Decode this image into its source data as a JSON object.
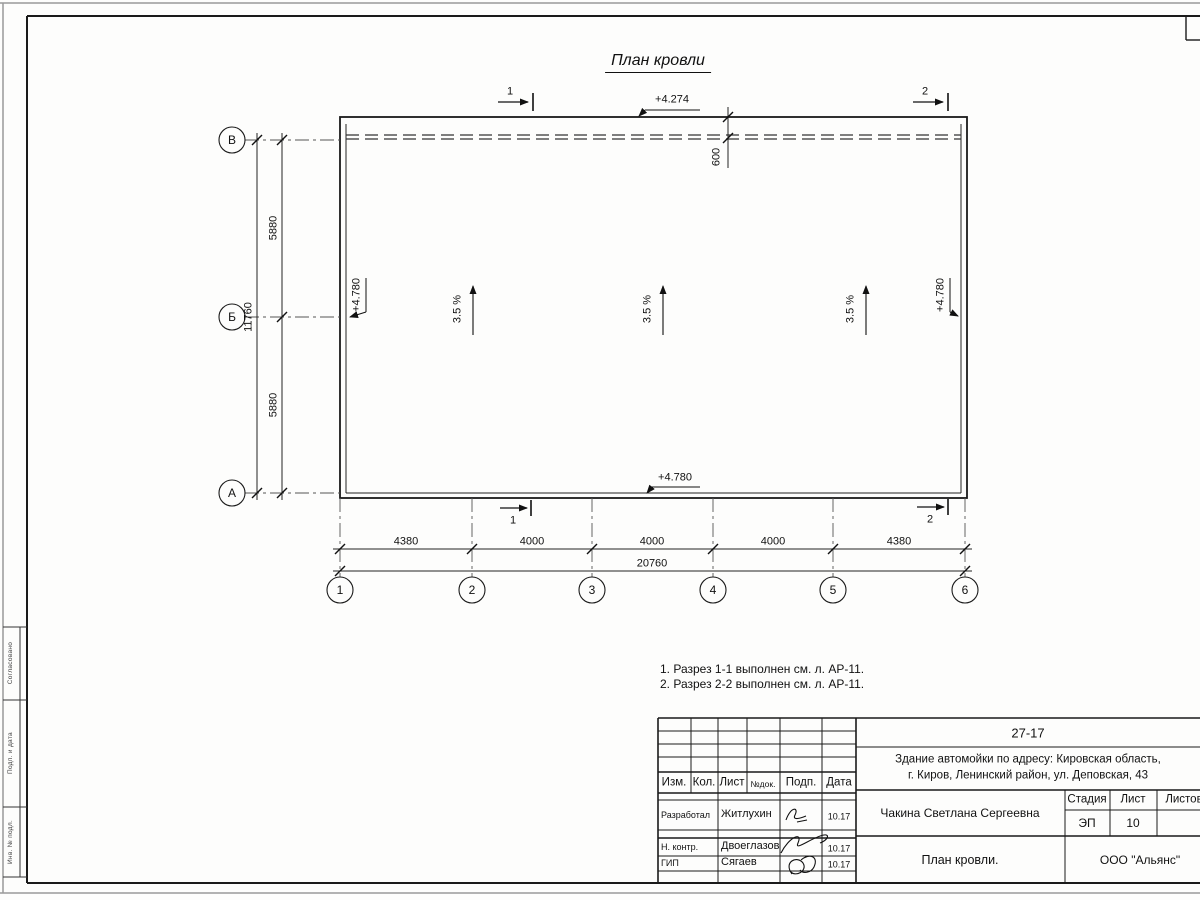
{
  "drawing": {
    "title": "План кровли",
    "slope_label": "3.5 %",
    "parapet_offset": "600",
    "elev_top": "+4.274",
    "elev_left": "+4.780",
    "elev_right": "+4.780",
    "elev_bottom": "+4.780",
    "section_1": "1",
    "section_2": "2",
    "axes": {
      "row_labels": [
        "В",
        "Б",
        "А"
      ],
      "col_labels": [
        "1",
        "2",
        "3",
        "4",
        "5",
        "6"
      ],
      "row_dims": [
        "5880",
        "5880"
      ],
      "row_total": "11760",
      "col_dims": [
        "4380",
        "4000",
        "4000",
        "4000",
        "4380"
      ],
      "col_total": "20760"
    }
  },
  "notes": [
    "1. Разрез 1-1 выполнен см. л. АР-11.",
    "2. Разрез 2-2 выполнен см. л. АР-11."
  ],
  "side_stamp": [
    "Согласовано",
    "Подп. и дата",
    "Инв. № подл."
  ],
  "title_block": {
    "doc_number": "27-17",
    "object_line1": "Здание автомойки по адресу: Кировская область,",
    "object_line2": "г. Киров, Ленинский район, ул. Деповская, 43",
    "header": [
      "Изм.",
      "Кол.",
      "Лист",
      "№док.",
      "Подп.",
      "Дата"
    ],
    "rows": [
      {
        "role": "Разработал",
        "name": "Житлухин",
        "date": "10.17"
      },
      {
        "role": "Н. контр.",
        "name": "Двоеглазов",
        "date": "10.17"
      },
      {
        "role": "ГИП",
        "name": "Сягаев",
        "date": "10.17"
      }
    ],
    "customer": "Чакина Светлана Сергеевна",
    "stage_label": "Стадия",
    "sheet_label": "Лист",
    "sheets_label": "Листов",
    "stage": "ЭП",
    "sheet": "10",
    "sheet_title": "План кровли.",
    "company": "ООО \"Альянс\""
  }
}
